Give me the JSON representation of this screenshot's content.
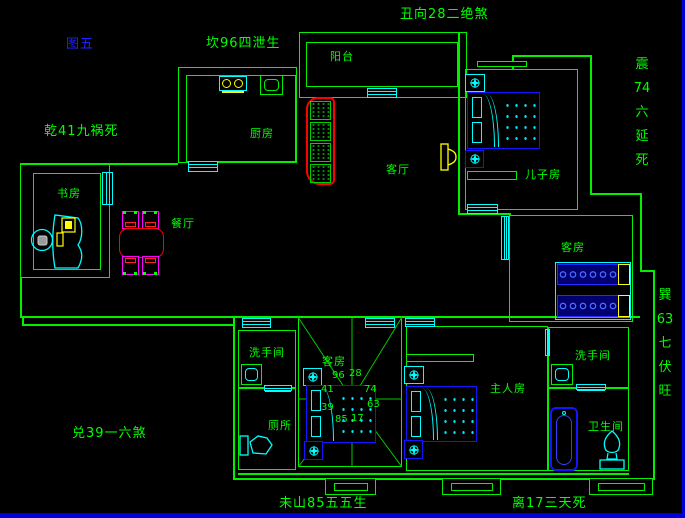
{
  "figure": {
    "label": "图五"
  },
  "fengshui": {
    "kan": "坎96四泄生",
    "chou": "丑向28二绝煞",
    "qian": "乾41九祸死",
    "dui": "兑39一六煞",
    "wei": "未山85五五生",
    "li": "离17三天死",
    "zhen": [
      "震",
      "74",
      "六",
      "延",
      "死"
    ],
    "xun": [
      "巽",
      "63",
      "七",
      "伏",
      "旺"
    ]
  },
  "rooms": {
    "balcony": "阳台",
    "kitchen": "厨房",
    "study": "书房",
    "dining": "餐厅",
    "living": "客厅",
    "son_room": "儿子房",
    "guest_room_top": "客房",
    "guest_room_mid": "客房",
    "washroom_left": "洗手间",
    "toilet_left": "厕所",
    "master_room": "主人房",
    "washroom_right": "洗手间",
    "bathroom_right": "卫生间"
  },
  "compass_numbers": [
    "96",
    "28",
    "41",
    "74",
    "39",
    "63",
    "85",
    "17"
  ],
  "colors": {
    "wall_green": "#00f000",
    "fixture_cyan": "#00ffff",
    "furniture_blue": "#1414ff",
    "accent_red": "#ff0000",
    "accent_magenta": "#ff00ff",
    "accent_yellow": "#ffff00",
    "figure_blue": "#2222ff",
    "window_edge_blue": "#0000dd",
    "background": "#000000"
  }
}
